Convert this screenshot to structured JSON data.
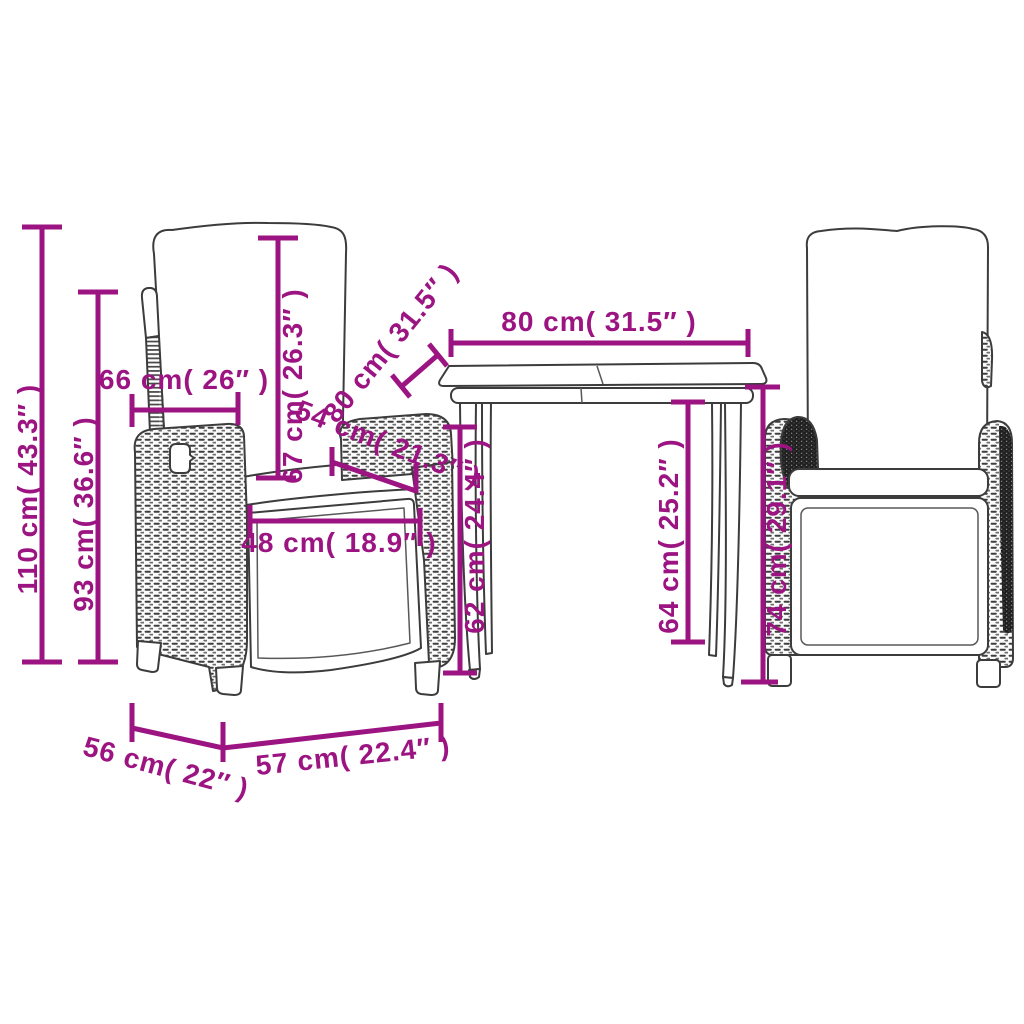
{
  "diagram": {
    "type": "product-dimension-diagram",
    "accent_color": "#9C1481",
    "outline_color": "#3C3C3C",
    "labels": {
      "chair_total_height_110": "110 cm( 43.3″ )",
      "chair_back_height_93": "93 cm( 36.6″ )",
      "chair_back_width_66": "66 cm( 26″ )",
      "backrest_height_67": "67 cm( 26.3″ )",
      "armrest_depth_54": "54 cm( 21.3″ )",
      "seat_width_48": "48 cm( 18.9″ )",
      "table_width_80": "80 cm( 31.5″ )",
      "table_depth_80": "80 cm( 31.5″ )",
      "seat_clearance_62": "62 cm( 24.4″ )",
      "table_clearance_64": "64 cm( 25.2″ )",
      "table_height_74": "74 cm( 29.1″ )",
      "chair_depth_56": "56 cm( 22″ )",
      "chair_width_57": "57 cm( 22.4″ )"
    }
  }
}
